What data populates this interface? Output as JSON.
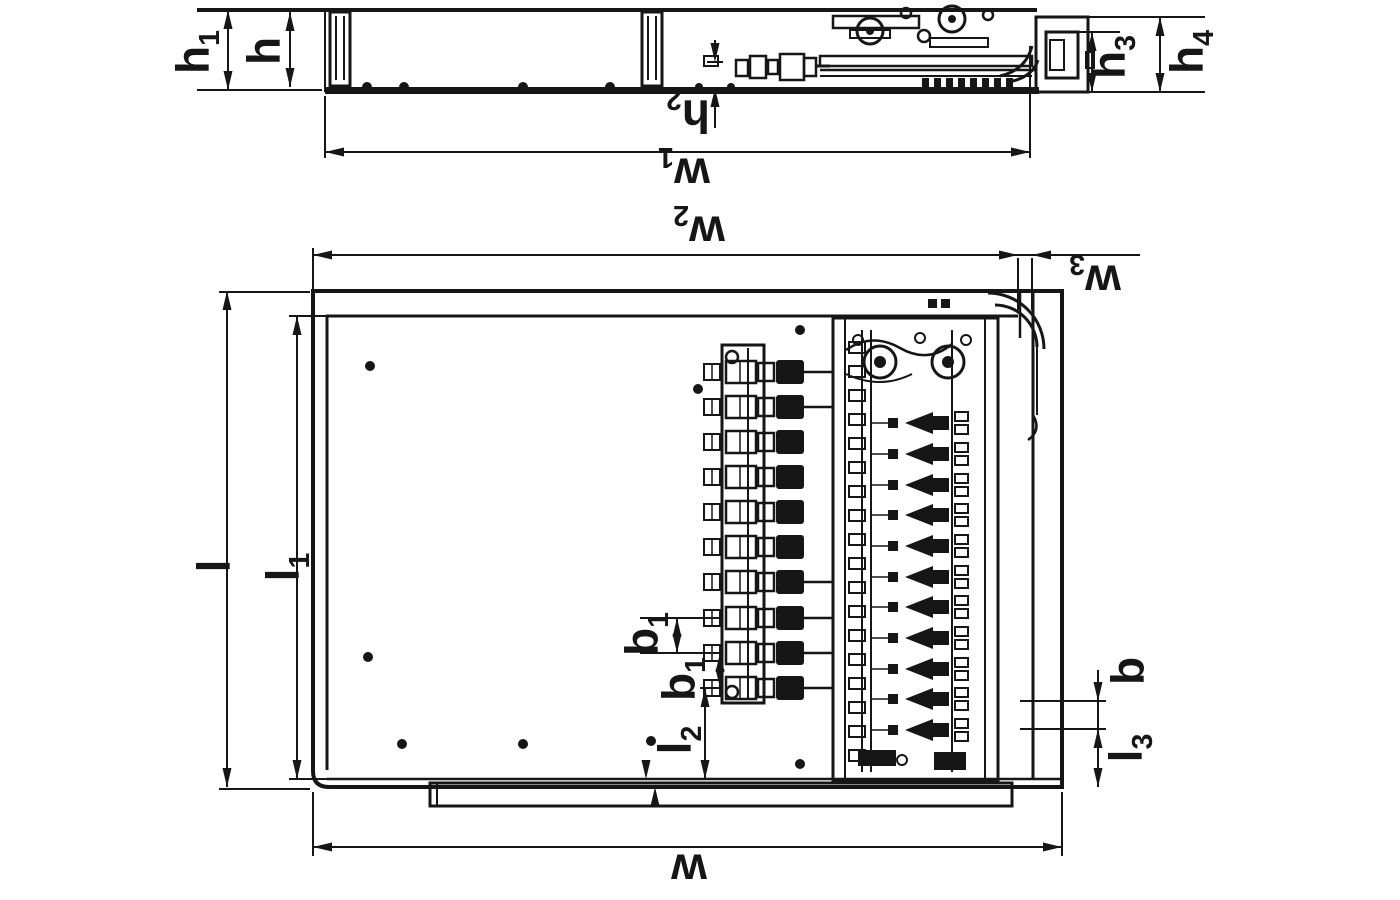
{
  "drawing": {
    "kind": "technical-dimension-drawing",
    "orientation": "rotated-180",
    "view_count": 2
  },
  "colors": {
    "ink": "#161616",
    "background": "#ffffff"
  },
  "dimensions": {
    "side_view": {
      "h1": {
        "base": "h",
        "sub": "1"
      },
      "h": {
        "base": "h",
        "sub": ""
      },
      "h2": {
        "base": "h",
        "sub": "2"
      },
      "h3": {
        "base": "h",
        "sub": "3"
      },
      "h4": {
        "base": "h",
        "sub": "4"
      },
      "w1": {
        "base": "w",
        "sub": "1"
      }
    },
    "top_view": {
      "w2": {
        "base": "w",
        "sub": "2"
      },
      "w3": {
        "base": "w",
        "sub": "3"
      },
      "l": {
        "base": "l",
        "sub": ""
      },
      "l1": {
        "base": "l",
        "sub": "1"
      },
      "b1_first": {
        "base": "b",
        "sub": "1"
      },
      "b1_second": {
        "base": "b",
        "sub": "1"
      },
      "l2": {
        "base": "l",
        "sub": "2"
      },
      "b": {
        "base": "b",
        "sub": ""
      },
      "l3": {
        "base": "l",
        "sub": "3"
      },
      "w": {
        "base": "w",
        "sub": ""
      }
    }
  }
}
